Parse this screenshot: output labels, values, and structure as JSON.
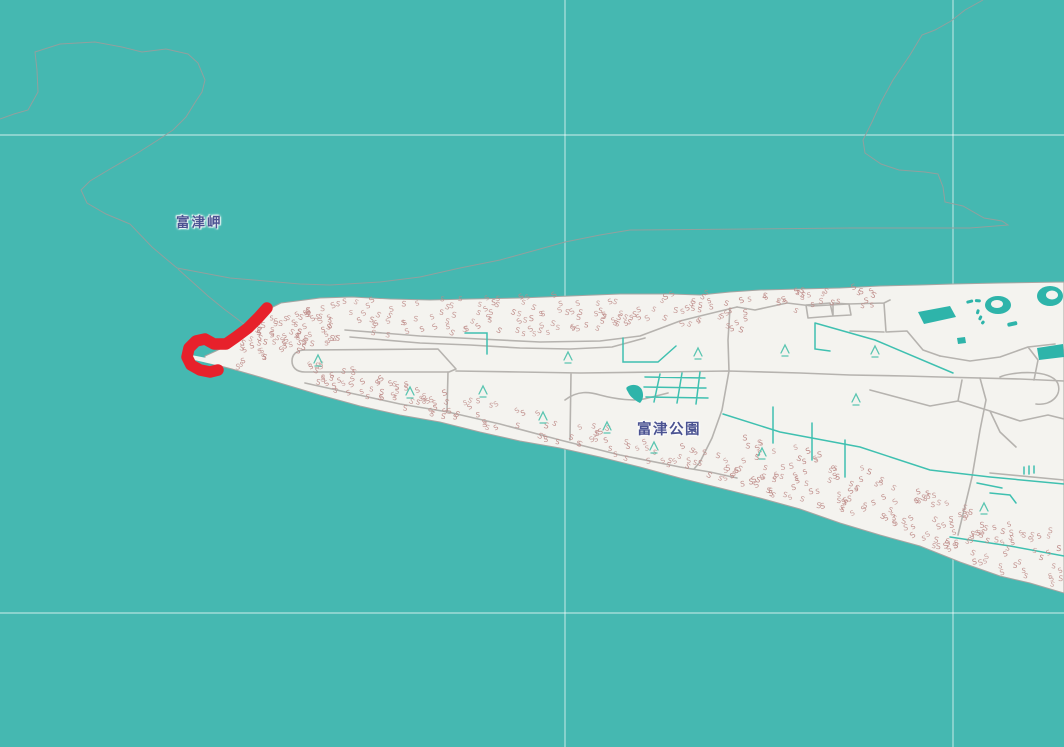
{
  "map": {
    "labels": {
      "cape": "富津岬",
      "park": "富津公園"
    },
    "colors": {
      "sea": "#45b8b1",
      "land": "#f4f3ef",
      "coast": "#a8a5a2",
      "sea_line": "#92a09e",
      "road": "#b6b3af",
      "vegetation_line": "#3fc0b0",
      "water_feature": "#2eb4aa",
      "scrub": "#bd8a87",
      "tree": "#5ac5b1",
      "route": "#e7212b",
      "label_text": "#4b5392",
      "graticule": "rgba(255,255,255,0.5)"
    },
    "route_points": [
      [
        267,
        308
      ],
      [
        258,
        318
      ],
      [
        248,
        328
      ],
      [
        236,
        337
      ],
      [
        226,
        344
      ],
      [
        214,
        344
      ],
      [
        205,
        339
      ],
      [
        196,
        341
      ],
      [
        189,
        348
      ],
      [
        187,
        357
      ],
      [
        191,
        365
      ],
      [
        200,
        370
      ],
      [
        210,
        372
      ],
      [
        218,
        370
      ]
    ],
    "trees": [
      [
        318,
        360
      ],
      [
        410,
        392
      ],
      [
        483,
        391
      ],
      [
        568,
        357
      ],
      [
        698,
        353
      ],
      [
        785,
        350
      ],
      [
        875,
        351
      ],
      [
        543,
        417
      ],
      [
        607,
        427
      ],
      [
        654,
        447
      ],
      [
        762,
        453
      ],
      [
        856,
        399
      ],
      [
        984,
        508
      ]
    ],
    "scrub": {
      "glyph": "S",
      "seed": 42,
      "bands": [
        {
          "x0": 292,
          "x1": 745,
          "count": 150,
          "line": [
            [
              292,
              303
            ],
            [
              400,
              299
            ],
            [
              500,
              297
            ],
            [
              620,
              294
            ],
            [
              745,
              292
            ]
          ],
          "min": 2,
          "max": 40,
          "dir": 1
        },
        {
          "x0": 745,
          "x1": 880,
          "count": 28,
          "line": [
            [
              745,
              292
            ],
            [
              880,
              287
            ]
          ],
          "min": 2,
          "max": 22,
          "dir": 1
        },
        {
          "x0": 235,
          "x1": 330,
          "count": 70,
          "line": [
            [
              235,
              332
            ],
            [
              270,
              310
            ],
            [
              330,
              304
            ]
          ],
          "min": 2,
          "max": 45,
          "dir": 1
        },
        {
          "x0": 300,
          "x1": 740,
          "count": 130,
          "line": [
            [
              300,
              389
            ],
            [
              400,
              415
            ],
            [
              500,
              437
            ],
            [
              600,
              458
            ],
            [
              700,
              483
            ],
            [
              740,
              494
            ]
          ],
          "min": 4,
          "max": 30,
          "dir": -1
        },
        {
          "x0": 740,
          "x1": 1060,
          "count": 175,
          "line": [
            [
              740,
              494
            ],
            [
              800,
              509
            ],
            [
              900,
              540
            ],
            [
              990,
              578
            ],
            [
              1060,
              592
            ]
          ],
          "min": 4,
          "max": 58,
          "dir": -1
        }
      ]
    },
    "water_features": {
      "polygons": [
        "918,312 950,306 956,317 924,324",
        "1037,348 1063,344 1064,357 1039,360",
        "957,338 965,337 966,343 958,344"
      ],
      "dashes": [
        [
          966,
          301,
          7,
          3,
          -15
        ],
        [
          975,
          299,
          6,
          3,
          5
        ],
        [
          1007,
          323,
          10,
          4,
          -12
        ],
        [
          977,
          309,
          3,
          5,
          15
        ],
        [
          980,
          315,
          3,
          5,
          25
        ],
        [
          983,
          320,
          3,
          4,
          40
        ]
      ],
      "rings": [
        {
          "cx": 998,
          "cy": 305,
          "rx": 13,
          "ry": 9,
          "icx": 997,
          "icy": 304,
          "irx": 6,
          "iry": 4
        },
        {
          "cx": 1050,
          "cy": 296,
          "rx": 13,
          "ry": 10,
          "icx": 1052,
          "icy": 295,
          "irx": 6,
          "iry": 4.5
        }
      ],
      "pond_path": "M627,387 C633,383 640,385 642,390 C644,395 643,400 640,403 C636,401 630,397 628,392 C626,389 626,388 627,387 Z"
    }
  }
}
